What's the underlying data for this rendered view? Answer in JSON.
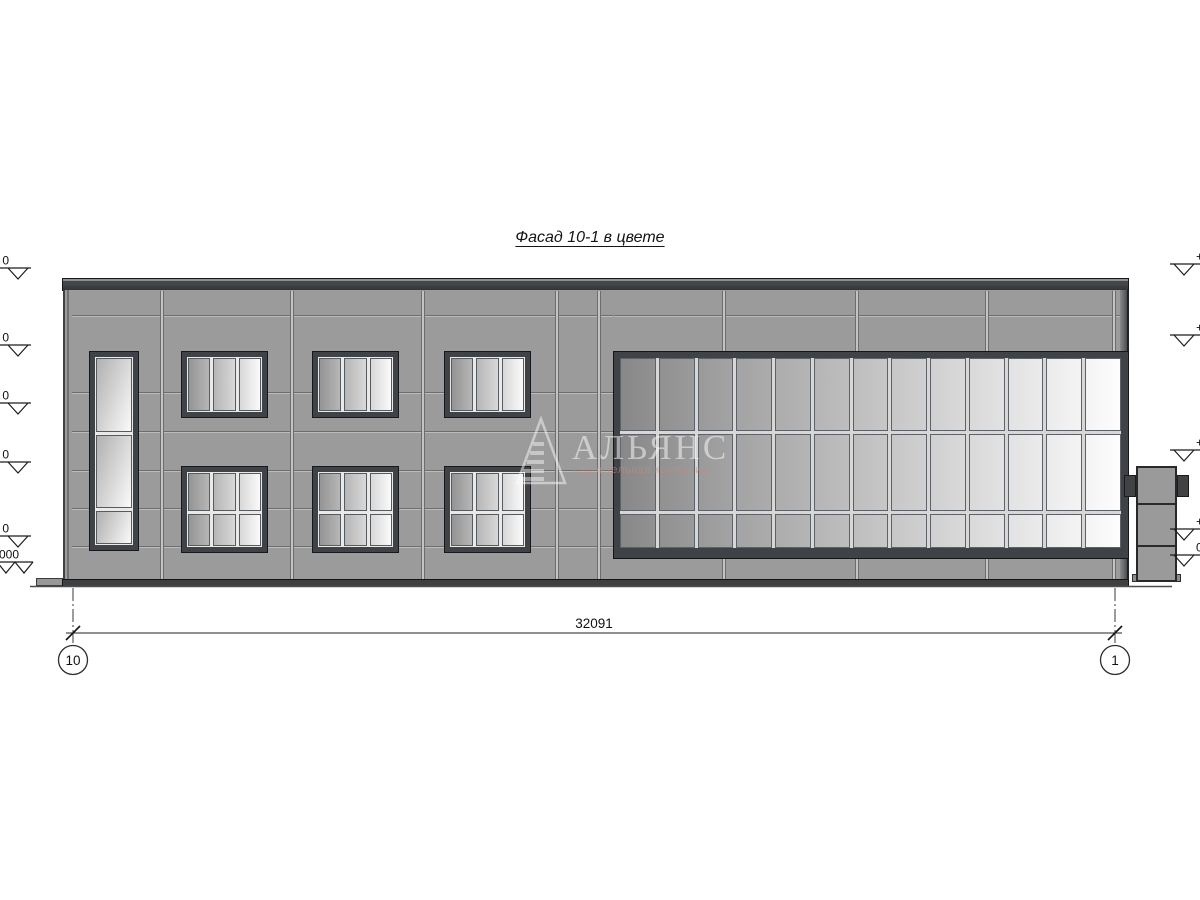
{
  "drawing": {
    "title": "Фасад 10-1 в цвете"
  },
  "dimension": {
    "total": "32091"
  },
  "grid_axes": {
    "left_bubble": "10",
    "right_bubble": "1"
  },
  "elevation_marks": {
    "left_fragments": [
      "0",
      "0",
      "0",
      "0",
      "0",
      ".000"
    ],
    "right_fragments": [
      "+",
      "+",
      "+",
      "+",
      "0"
    ]
  },
  "watermark": {
    "company": "АЛЬЯНС",
    "tagline": "строительная компания"
  },
  "colors": {
    "facade_panel": "#9b9b9b",
    "parapet_cap": "#3a3d3f",
    "window_frame": "#3f4347",
    "glass_gradient_dark": "#888888",
    "glass_gradient_light": "#ffffff",
    "annotation_line": "#222222",
    "watermark_text": "#f6f6f6",
    "watermark_tagline": "#c48c82"
  }
}
